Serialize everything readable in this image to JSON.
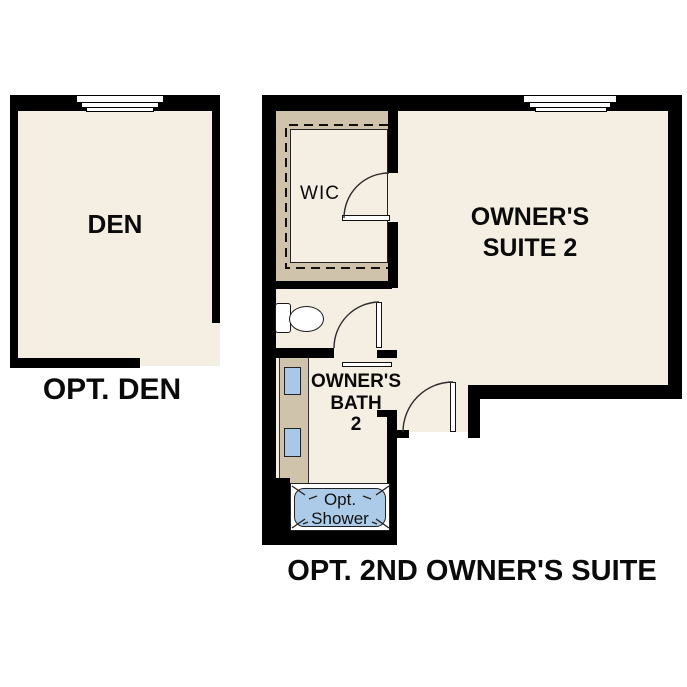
{
  "den": {
    "room_label": "DEN",
    "caption": "OPT. DEN"
  },
  "suite": {
    "wic_label": "WIC",
    "room_label_line1": "OWNER'S",
    "room_label_line2": "SUITE 2",
    "bath_label_line1": "OWNER'S",
    "bath_label_line2": "BATH",
    "bath_label_line3": "2",
    "shower_label_line1": "Opt.",
    "shower_label_line2": "Shower",
    "caption": "OPT. 2ND OWNER'S SUITE"
  },
  "colors": {
    "wall": "#000000",
    "floor": "#f5eee3",
    "millwork_tan": "#cfc3ab",
    "fixture_blue": "#a9c8e9",
    "shower_blue": "#abcbe9",
    "line": "#222222",
    "background": "#ffffff"
  }
}
